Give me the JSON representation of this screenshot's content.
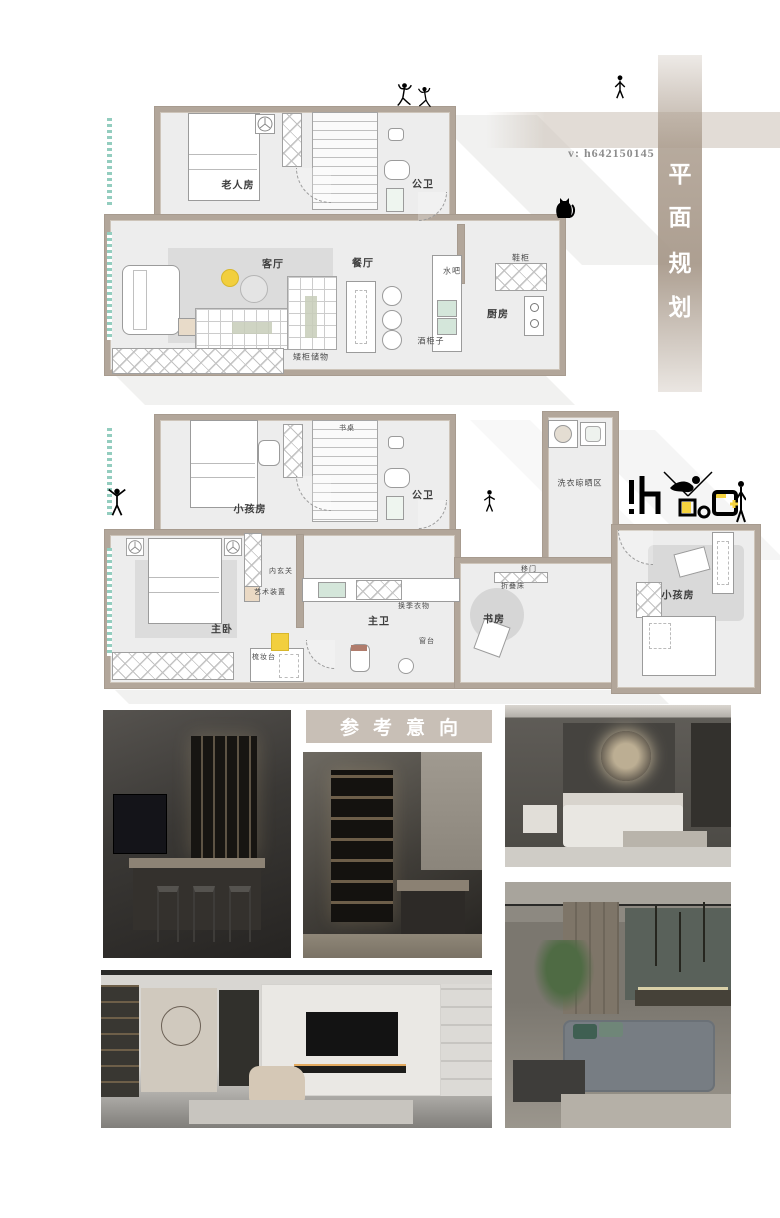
{
  "watermark": {
    "text": "v: h642150145"
  },
  "vertical_banner": {
    "chars": [
      "平",
      "面",
      "规",
      "划"
    ]
  },
  "section_header": {
    "label": "参考意向"
  },
  "plan_upper": {
    "labels": {
      "elder_room": "老人房",
      "public_bath": "公卫",
      "living_room": "客厅",
      "dining_room": "餐厅",
      "water_bar": "水吧",
      "shoe_cabinet": "鞋柜",
      "kitchen": "厨房",
      "wine_cabinet": "酒柜子",
      "bench_storage": "矮柜储物"
    }
  },
  "plan_lower": {
    "labels": {
      "kids_room_top": "小孩房",
      "desk": "书桌",
      "public_bath": "公卫",
      "laundry_area": "洗衣晾晒区",
      "master_bedroom": "主卧",
      "inner_hall": "内玄关",
      "art_installation": "艺术装置",
      "dressing_table": "梳妆台",
      "master_bath": "主卫",
      "seasonal_closet": "换季衣物",
      "window_sill": "窗台",
      "study": "书房",
      "folding_bed": "折叠床",
      "sliding_door": "移门",
      "kids_room_right": "小孩房"
    }
  },
  "colors": {
    "wall_tan": "#b2a69a",
    "band_tan": "#c8bfb6",
    "accent_yellow": "#f2cf3e",
    "hatch_teal": "#93cdbf",
    "logo_yellow": "#f5d33f"
  }
}
